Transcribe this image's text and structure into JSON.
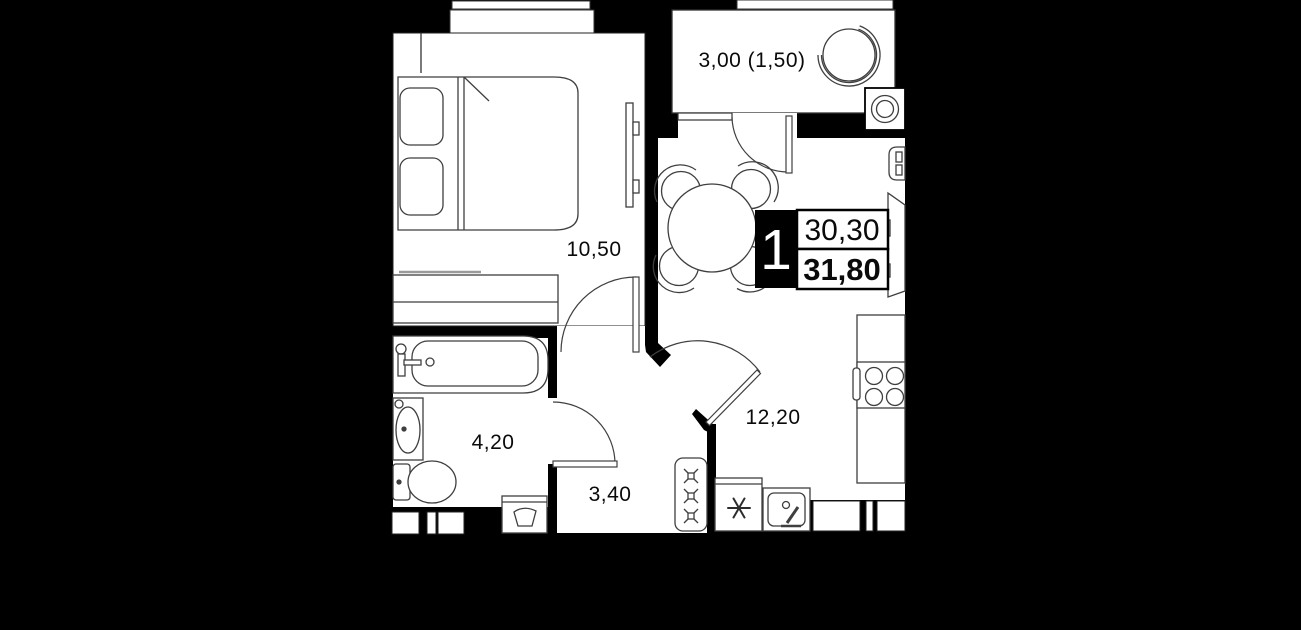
{
  "plan": {
    "type": "apartment-floor-plan",
    "room_labels": {
      "bedroom": "10,50",
      "balcony": "3,00 (1,50)",
      "kitchen_living": "12,20",
      "bathroom": "4,20",
      "hallway": "3,40"
    },
    "unit_card": {
      "rooms_count": "1",
      "upper_area": "30,30",
      "lower_area": "31,80"
    },
    "fixtures": [
      "bed",
      "wardrobe",
      "tv",
      "bathtub",
      "washbasin",
      "toilet",
      "washing-machine",
      "shoe-cabinet",
      "dining-table",
      "chairs",
      "refrigerator",
      "kitchen-sink",
      "stove",
      "counter",
      "boiler",
      "vent-fan",
      "balcony-chair"
    ]
  },
  "colors": {
    "background": "#000000",
    "floor": "#ffffff",
    "wall": "#000000",
    "furniture_line": "#3f3f3f",
    "card_box_border": "#000000",
    "card_number_bg": "#000000",
    "card_number_text": "#ffffff"
  }
}
